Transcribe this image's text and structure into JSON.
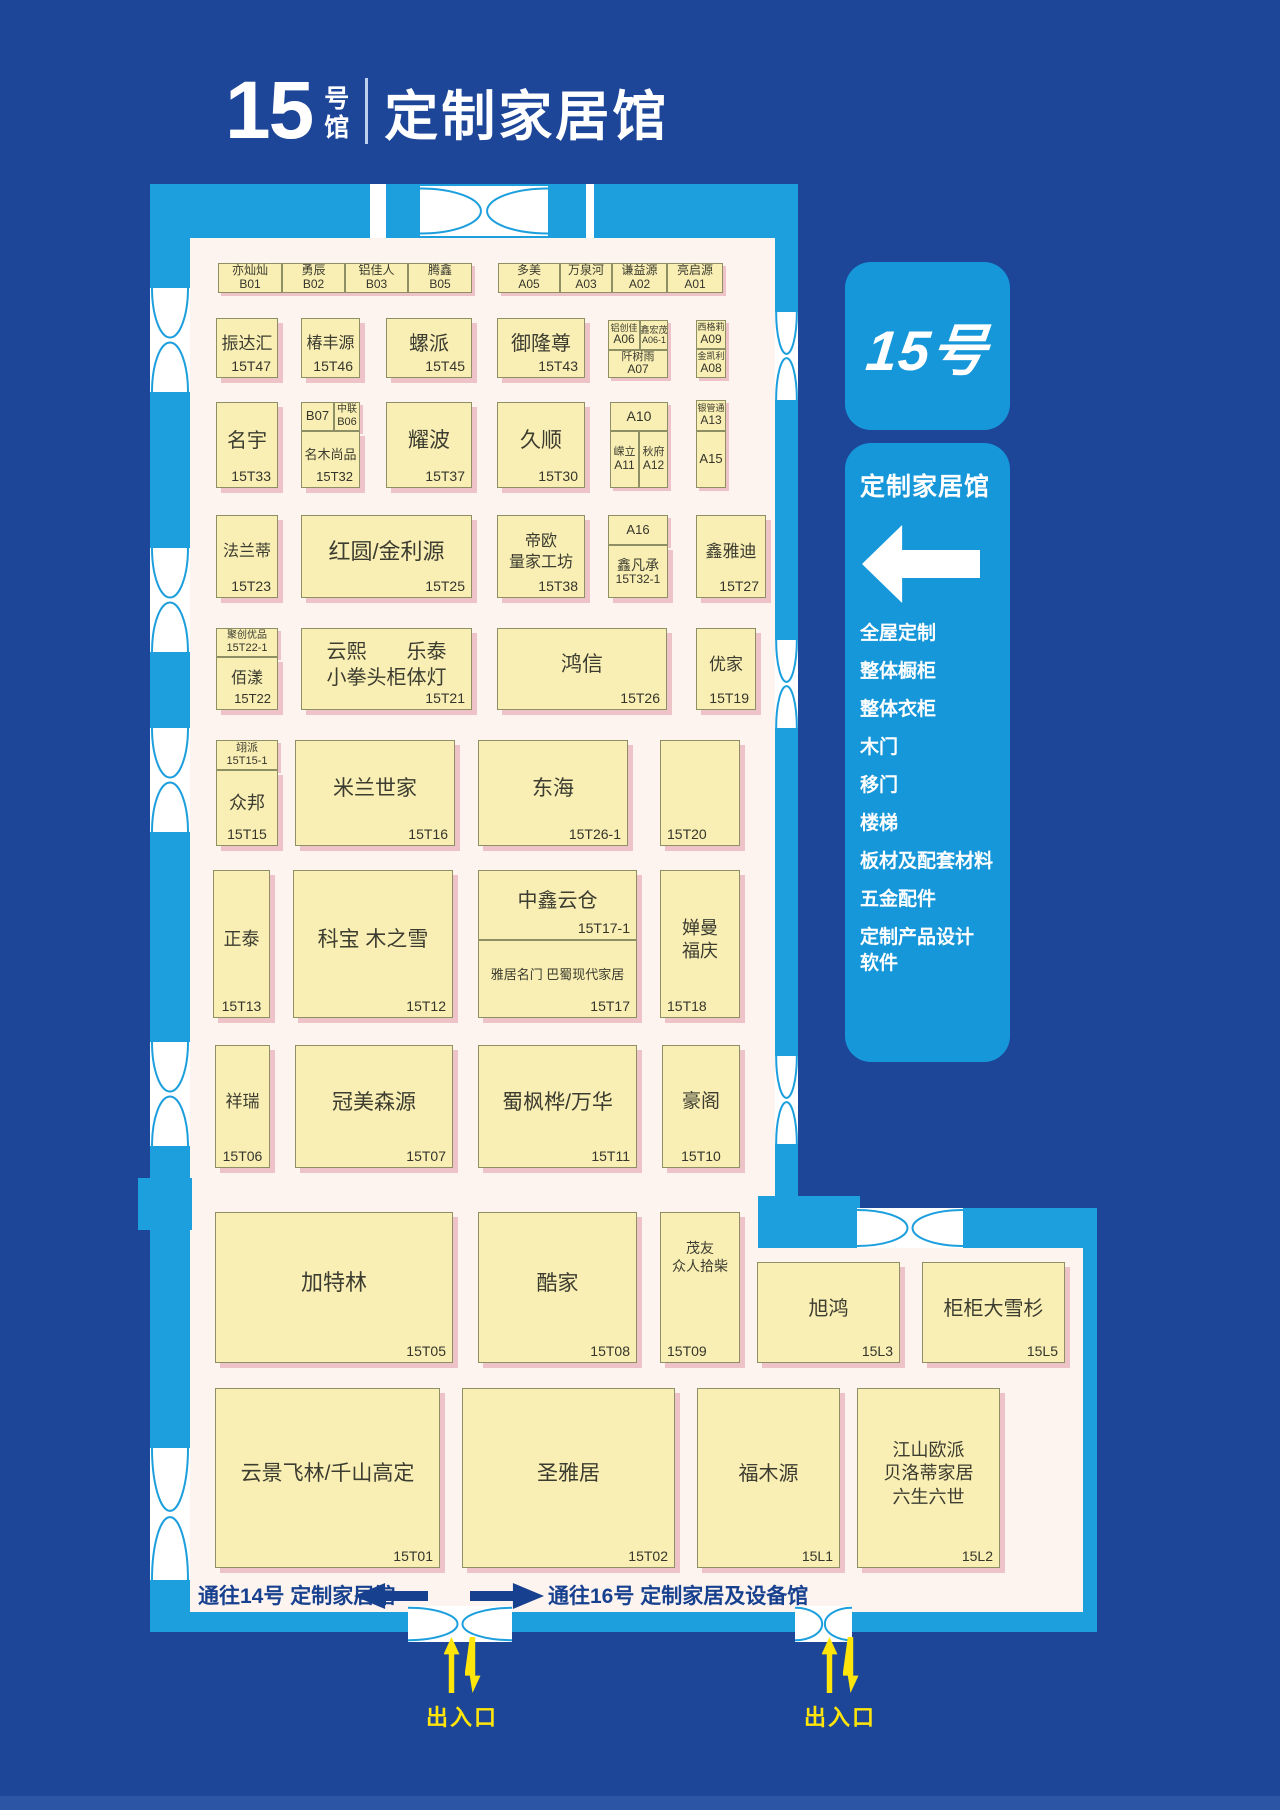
{
  "title": {
    "number": "15",
    "number_unit": "号",
    "hall_word": "馆",
    "name": "定制家居馆"
  },
  "panel": {
    "badge": "15号",
    "title": "定制家居馆",
    "categories": [
      "全屋定制",
      "整体橱柜",
      "整体衣柜",
      "木门",
      "移门",
      "楼梯",
      "板材及配套材料",
      "五金配件",
      "定制产品设计\n软件"
    ]
  },
  "corridor": {
    "to14": "通往14号 定制家居馆",
    "to16": "通往16号 定制家居及设备馆"
  },
  "entrances": [
    {
      "label": "出入口"
    },
    {
      "label": "出入口"
    }
  ],
  "colors": {
    "background_navy": "#1d4699",
    "wall_cyan": "#1d9fdd",
    "panel_blue": "#1697da",
    "floor_pink_white": "#fdf3ef",
    "booth_yellow": "#f9efb4",
    "booth_shadow_pink": "#edc3c7",
    "entrance_yellow": "#ffe50a"
  },
  "map": {
    "floors": [
      {
        "x": 150,
        "y": 184,
        "w": 648,
        "h": 1448
      },
      {
        "x": 775,
        "y": 1248,
        "w": 308,
        "h": 364
      }
    ],
    "bands": [
      {
        "x": 150,
        "y": 184,
        "w": 648,
        "h": 54
      },
      {
        "x": 150,
        "y": 238,
        "w": 40,
        "h": 1374
      },
      {
        "x": 775,
        "y": 238,
        "w": 23,
        "h": 1010
      },
      {
        "x": 150,
        "y": 1612,
        "w": 947,
        "h": 20
      },
      {
        "x": 798,
        "y": 1208,
        "w": 299,
        "h": 40
      },
      {
        "x": 758,
        "y": 1196,
        "w": 102,
        "h": 52
      },
      {
        "x": 1083,
        "y": 1248,
        "w": 14,
        "h": 364
      },
      {
        "x": 138,
        "y": 1178,
        "w": 54,
        "h": 52
      }
    ],
    "slits": [
      {
        "x": 370,
        "y": 184,
        "w": 16,
        "h": 54
      },
      {
        "x": 586,
        "y": 184,
        "w": 8,
        "h": 54
      }
    ],
    "doors": [
      {
        "x": 420,
        "y": 186,
        "w": 128,
        "h": 50,
        "o": "h"
      },
      {
        "x": 150,
        "y": 288,
        "w": 40,
        "h": 104,
        "o": "v"
      },
      {
        "x": 150,
        "y": 548,
        "w": 40,
        "h": 104,
        "o": "v"
      },
      {
        "x": 150,
        "y": 728,
        "w": 40,
        "h": 104,
        "o": "v"
      },
      {
        "x": 150,
        "y": 1042,
        "w": 40,
        "h": 104,
        "o": "v"
      },
      {
        "x": 150,
        "y": 1448,
        "w": 40,
        "h": 132,
        "o": "v"
      },
      {
        "x": 775,
        "y": 312,
        "w": 23,
        "h": 88,
        "o": "v"
      },
      {
        "x": 775,
        "y": 640,
        "w": 23,
        "h": 88,
        "o": "v"
      },
      {
        "x": 775,
        "y": 1056,
        "w": 23,
        "h": 88,
        "o": "v"
      },
      {
        "x": 408,
        "y": 1606,
        "w": 104,
        "h": 36,
        "o": "h"
      },
      {
        "x": 795,
        "y": 1606,
        "w": 57,
        "h": 36,
        "o": "h"
      },
      {
        "x": 857,
        "y": 1208,
        "w": 106,
        "h": 40,
        "o": "h"
      }
    ],
    "booths": [
      {
        "x": 218,
        "y": 263,
        "w": 64,
        "h": 30,
        "v": "stack",
        "lines": [
          "亦灿灿"
        ],
        "num": "B01",
        "fs": 12,
        "nfs": 12
      },
      {
        "x": 282,
        "y": 263,
        "w": 63,
        "h": 30,
        "v": "stack",
        "lines": [
          "勇辰"
        ],
        "num": "B02",
        "fs": 12,
        "nfs": 12
      },
      {
        "x": 345,
        "y": 263,
        "w": 63,
        "h": 30,
        "v": "stack",
        "lines": [
          "铝佳人"
        ],
        "num": "B03",
        "fs": 12,
        "nfs": 12
      },
      {
        "x": 408,
        "y": 263,
        "w": 64,
        "h": 30,
        "v": "stack",
        "lines": [
          "腾鑫"
        ],
        "num": "B05",
        "fs": 12,
        "nfs": 12
      },
      {
        "x": 498,
        "y": 263,
        "w": 62,
        "h": 30,
        "v": "stack",
        "lines": [
          "多美"
        ],
        "num": "A05",
        "fs": 12,
        "nfs": 12
      },
      {
        "x": 560,
        "y": 263,
        "w": 52,
        "h": 30,
        "v": "stack",
        "lines": [
          "万泉河"
        ],
        "num": "A03",
        "fs": 12,
        "nfs": 12
      },
      {
        "x": 612,
        "y": 263,
        "w": 55,
        "h": 30,
        "v": "stack",
        "lines": [
          "谦益源"
        ],
        "num": "A02",
        "fs": 12,
        "nfs": 12
      },
      {
        "x": 667,
        "y": 263,
        "w": 56,
        "h": 30,
        "v": "stack",
        "lines": [
          "亮启源"
        ],
        "num": "A01",
        "fs": 12,
        "nfs": 12
      },
      {
        "x": 216,
        "y": 318,
        "w": 62,
        "h": 60,
        "lines": [
          "振达汇"
        ],
        "num": "15T47",
        "fs": 17
      },
      {
        "x": 301,
        "y": 318,
        "w": 59,
        "h": 60,
        "lines": [
          "椿丰源"
        ],
        "num": "15T46",
        "fs": 16
      },
      {
        "x": 386,
        "y": 318,
        "w": 86,
        "h": 60,
        "lines": [
          "螺派"
        ],
        "num": "15T45",
        "fs": 20
      },
      {
        "x": 497,
        "y": 318,
        "w": 88,
        "h": 60,
        "lines": [
          "御隆尊"
        ],
        "num": "15T43",
        "fs": 20
      },
      {
        "x": 608,
        "y": 320,
        "w": 32,
        "h": 30,
        "v": "stack",
        "lines": [
          "铝创佳"
        ],
        "num": "A06",
        "fs": 9,
        "nfs": 12
      },
      {
        "x": 640,
        "y": 320,
        "w": 28,
        "h": 30,
        "v": "stack",
        "lines": [
          "鑫宏茂"
        ],
        "num": "A06-1",
        "fs": 9,
        "nfs": 9
      },
      {
        "x": 608,
        "y": 350,
        "w": 60,
        "h": 28,
        "v": "stack",
        "lines": [
          "阡树雨"
        ],
        "num": "A07",
        "fs": 11,
        "nfs": 12
      },
      {
        "x": 696,
        "y": 320,
        "w": 30,
        "h": 29,
        "v": "stack",
        "lines": [
          "西格莉"
        ],
        "num": "A09",
        "fs": 9,
        "nfs": 12
      },
      {
        "x": 696,
        "y": 349,
        "w": 30,
        "h": 29,
        "v": "stack",
        "lines": [
          "金凯利"
        ],
        "num": "A08",
        "fs": 9,
        "nfs": 12
      },
      {
        "x": 216,
        "y": 402,
        "w": 62,
        "h": 86,
        "lines": [
          "名宇"
        ],
        "num": "15T33",
        "fs": 20
      },
      {
        "x": 301,
        "y": 402,
        "w": 33,
        "h": 29,
        "v": "num",
        "num": "B07",
        "nfs": 13,
        "np": "c"
      },
      {
        "x": 334,
        "y": 402,
        "w": 26,
        "h": 29,
        "v": "stack",
        "lines": [
          "中联"
        ],
        "num": "B06",
        "fs": 10,
        "nfs": 11
      },
      {
        "x": 301,
        "y": 431,
        "w": 59,
        "h": 57,
        "lines": [
          "名木尚品"
        ],
        "num": "15T32",
        "fs": 13,
        "nfs": 13
      },
      {
        "x": 386,
        "y": 402,
        "w": 86,
        "h": 86,
        "lines": [
          "耀波"
        ],
        "num": "15T37",
        "fs": 21
      },
      {
        "x": 497,
        "y": 402,
        "w": 88,
        "h": 86,
        "lines": [
          "久顺"
        ],
        "num": "15T30",
        "fs": 21
      },
      {
        "x": 610,
        "y": 402,
        "w": 58,
        "h": 29,
        "v": "num",
        "num": "A10",
        "nfs": 14,
        "np": "c"
      },
      {
        "x": 610,
        "y": 431,
        "w": 29,
        "h": 57,
        "v": "stack",
        "lines": [
          "嵘立"
        ],
        "num": "A11",
        "fs": 11,
        "nfs": 12
      },
      {
        "x": 639,
        "y": 431,
        "w": 29,
        "h": 57,
        "v": "stack",
        "lines": [
          "秋府"
        ],
        "num": "A12",
        "fs": 11,
        "nfs": 12
      },
      {
        "x": 696,
        "y": 400,
        "w": 30,
        "h": 31,
        "v": "stack",
        "lines": [
          "银管通"
        ],
        "num": "A13",
        "fs": 9,
        "nfs": 12
      },
      {
        "x": 696,
        "y": 431,
        "w": 30,
        "h": 57,
        "v": "num",
        "num": "A15",
        "nfs": 13,
        "np": "c"
      },
      {
        "x": 216,
        "y": 515,
        "w": 62,
        "h": 83,
        "lines": [
          "法兰蒂"
        ],
        "num": "15T23",
        "fs": 16
      },
      {
        "x": 301,
        "y": 515,
        "w": 171,
        "h": 83,
        "lines": [
          "红圆/金利源"
        ],
        "num": "15T25",
        "fs": 22
      },
      {
        "x": 497,
        "y": 515,
        "w": 88,
        "h": 83,
        "lines": [
          "帝欧",
          "量家工坊"
        ],
        "num": "15T38",
        "fs": 16
      },
      {
        "x": 608,
        "y": 515,
        "w": 60,
        "h": 30,
        "v": "num",
        "num": "A16",
        "nfs": 13,
        "np": "c"
      },
      {
        "x": 608,
        "y": 545,
        "w": 60,
        "h": 53,
        "v": "stack",
        "lines": [
          "鑫凡承"
        ],
        "num": "15T32-1",
        "fs": 14,
        "nfs": 12
      },
      {
        "x": 696,
        "y": 515,
        "w": 70,
        "h": 83,
        "lines": [
          "鑫雅迪"
        ],
        "num": "15T27",
        "fs": 17
      },
      {
        "x": 216,
        "y": 628,
        "w": 62,
        "h": 29,
        "v": "stack",
        "lines": [
          "聚创优品"
        ],
        "num": "15T22-1",
        "fs": 10,
        "nfs": 11
      },
      {
        "x": 216,
        "y": 657,
        "w": 62,
        "h": 53,
        "lines": [
          "佰漾"
        ],
        "num": "15T22",
        "fs": 16,
        "nfs": 13
      },
      {
        "x": 301,
        "y": 628,
        "w": 171,
        "h": 82,
        "lines": [
          "云熙　　乐泰",
          "小拳头柜体灯"
        ],
        "num": "15T21",
        "fs": 20
      },
      {
        "x": 497,
        "y": 628,
        "w": 170,
        "h": 82,
        "lines": [
          "鸿信"
        ],
        "num": "15T26",
        "fs": 21
      },
      {
        "x": 696,
        "y": 628,
        "w": 60,
        "h": 82,
        "lines": [
          "优家"
        ],
        "num": "15T19",
        "fs": 17
      },
      {
        "x": 216,
        "y": 740,
        "w": 62,
        "h": 30,
        "v": "stack",
        "lines": [
          "翊派"
        ],
        "num": "15T15-1",
        "fs": 11,
        "nfs": 11
      },
      {
        "x": 216,
        "y": 770,
        "w": 62,
        "h": 76,
        "lines": [
          "众邦"
        ],
        "num": "15T15",
        "fs": 18,
        "np": "bc"
      },
      {
        "x": 295,
        "y": 740,
        "w": 160,
        "h": 106,
        "lines": [
          "米兰世家"
        ],
        "num": "15T16",
        "fs": 21
      },
      {
        "x": 478,
        "y": 740,
        "w": 150,
        "h": 106,
        "lines": [
          "东海"
        ],
        "num": "15T26-1",
        "fs": 21
      },
      {
        "x": 660,
        "y": 740,
        "w": 80,
        "h": 106,
        "v": "num",
        "num": "15T20",
        "nfs": 14,
        "np": "bl"
      },
      {
        "x": 213,
        "y": 870,
        "w": 57,
        "h": 148,
        "lines": [
          "正泰"
        ],
        "num": "15T13",
        "fs": 18,
        "np": "bc"
      },
      {
        "x": 293,
        "y": 870,
        "w": 160,
        "h": 148,
        "lines": [
          "科宝 木之雪"
        ],
        "num": "15T12",
        "fs": 21
      },
      {
        "x": 478,
        "y": 870,
        "w": 159,
        "h": 70,
        "lines": [
          "中鑫云仓"
        ],
        "num": "15T17-1",
        "fs": 20
      },
      {
        "x": 478,
        "y": 940,
        "w": 159,
        "h": 78,
        "lines": [
          "雅居名门 巴蜀现代家居"
        ],
        "num": "15T17",
        "fs": 13
      },
      {
        "x": 660,
        "y": 870,
        "w": 80,
        "h": 148,
        "lines": [
          "婵曼",
          "福庆"
        ],
        "num": "15T18",
        "fs": 18,
        "np": "bl"
      },
      {
        "x": 215,
        "y": 1045,
        "w": 55,
        "h": 123,
        "lines": [
          "祥瑞"
        ],
        "num": "15T06",
        "fs": 17,
        "np": "bc"
      },
      {
        "x": 295,
        "y": 1045,
        "w": 158,
        "h": 123,
        "lines": [
          "冠美森源"
        ],
        "num": "15T07",
        "fs": 21
      },
      {
        "x": 478,
        "y": 1045,
        "w": 159,
        "h": 123,
        "lines": [
          "蜀枫桦/万华"
        ],
        "num": "15T11",
        "fs": 21
      },
      {
        "x": 662,
        "y": 1045,
        "w": 78,
        "h": 123,
        "lines": [
          "豪阁"
        ],
        "num": "15T10",
        "fs": 19,
        "np": "bc"
      },
      {
        "x": 215,
        "y": 1212,
        "w": 238,
        "h": 151,
        "lines": [
          "加特林"
        ],
        "num": "15T05",
        "fs": 22
      },
      {
        "x": 478,
        "y": 1212,
        "w": 159,
        "h": 151,
        "lines": [
          "酷家"
        ],
        "num": "15T08",
        "fs": 21
      },
      {
        "x": 660,
        "y": 1212,
        "w": 80,
        "h": 151,
        "lines": [
          "茂友",
          "众人拾柴"
        ],
        "num": "15T09",
        "fs": 14,
        "np": "bl",
        "va": "top"
      },
      {
        "x": 757,
        "y": 1262,
        "w": 143,
        "h": 101,
        "lines": [
          "旭鸿"
        ],
        "num": "15L3",
        "fs": 20
      },
      {
        "x": 922,
        "y": 1262,
        "w": 143,
        "h": 101,
        "lines": [
          "柜柜大雪杉"
        ],
        "num": "15L5",
        "fs": 20
      },
      {
        "x": 215,
        "y": 1388,
        "w": 225,
        "h": 180,
        "lines": [
          "云景飞林/千山高定"
        ],
        "num": "15T01",
        "fs": 21
      },
      {
        "x": 462,
        "y": 1388,
        "w": 213,
        "h": 180,
        "lines": [
          "圣雅居"
        ],
        "num": "15T02",
        "fs": 21
      },
      {
        "x": 697,
        "y": 1388,
        "w": 143,
        "h": 180,
        "lines": [
          "福木源"
        ],
        "num": "15L1",
        "fs": 20
      },
      {
        "x": 857,
        "y": 1388,
        "w": 143,
        "h": 180,
        "lines": [
          "江山欧派",
          "贝洛蒂家居",
          "六生六世"
        ],
        "num": "15L2",
        "fs": 18
      }
    ]
  }
}
